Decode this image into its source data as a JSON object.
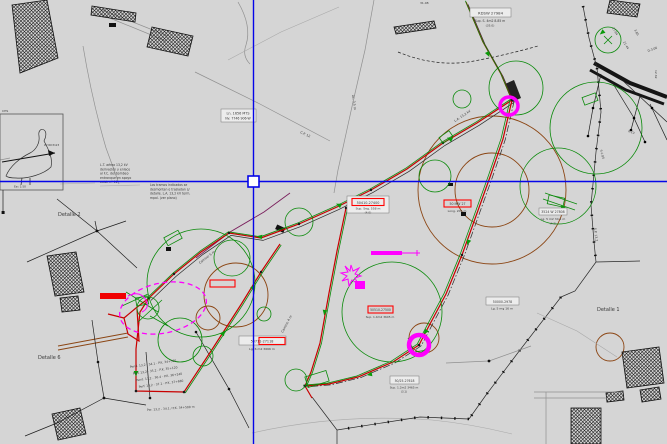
{
  "palette": {
    "background": "#d5d5d5",
    "crosshair_blue": "#0505e8",
    "road_red": "#c80000",
    "markup_red": "#ff0000",
    "green": "#0a8a0a",
    "brown": "#8b4513",
    "magenta": "#ff00ff"
  },
  "cursor": {
    "x": 254,
    "y": 181,
    "pickbox": 11
  },
  "detail_labels": [
    {
      "text": "Detalle 2"
    },
    {
      "text": "Detalle 6"
    },
    {
      "text": "Detalle 1"
    }
  ],
  "boxed_labels": [
    {
      "title": "Ln. 1656 MTS",
      "sub": "Nv. 7746 906-W"
    },
    {
      "title": "RDSW 27984",
      "sub": "Sup. S. 4m2 8.85 m",
      "sub2": "(35.0)"
    },
    {
      "title": "3524 W 27808",
      "sub": "Lg. 5 m2 34.1 m",
      "sub2": "(4.2)"
    },
    {
      "title": "50410-27400",
      "sub": "Sup. Seg. 558 m",
      "sub2": "(4.0)"
    },
    {
      "title": "50 MW 27",
      "sub": "Long. 204 m"
    },
    {
      "title": "50711-27118",
      "sub": "Lg. 6 m2 3666 m"
    },
    {
      "title": "50510-27500",
      "sub": "Sup. 1.4m2 3605 m"
    },
    {
      "title": "50000-2978",
      "sub": "Lg. 5 mg 16 m"
    },
    {
      "title": "50/25-27618",
      "sub": "Sup. 1.2m2 3465 m",
      "sub2": "(3.1)"
    }
  ],
  "legend": {
    "corner": "CHS",
    "bird_note": "W/ RD3123",
    "bird_scale": "Esc 1:50"
  },
  "notes": {
    "left_block": [
      "L.T. aérea 13,2 kV",
      "derivación y enlace",
      "al F.C. del bombeo",
      "entronque en apoyo",
      "exist. nº 12"
    ],
    "right_block": [
      "Los tramos indicados se",
      "desmontan o trasladan s/",
      "detalle. L.A. 13,2 kV term.",
      "mpal. (ver plano)"
    ],
    "bottom_rows": [
      "Pend. 13,2 - 34.1 - P.K. 34+500",
      "Perf. 13,2 - 35.2 - P.K. 35+120",
      "Pend. 13,2 - 36.4 - P.K. 36+240",
      "Perf. 13,2 - 37.1 - P.K. 37+680"
    ],
    "bottom_line": "Per. 13,2 - 34.1 / P.K. 34+500 m"
  },
  "road_labels": [
    "Camino 5 m",
    "Ac. 3,5 m",
    "C.P. 12",
    "Camino 4 m",
    "S.P. 13,2",
    "L.A. 13,2 kV"
  ],
  "survey_labels": [
    "27.64",
    "21.44",
    "3.85",
    "D-3.06",
    "12.62",
    "S-1.85",
    "K-13",
    "31.08"
  ]
}
